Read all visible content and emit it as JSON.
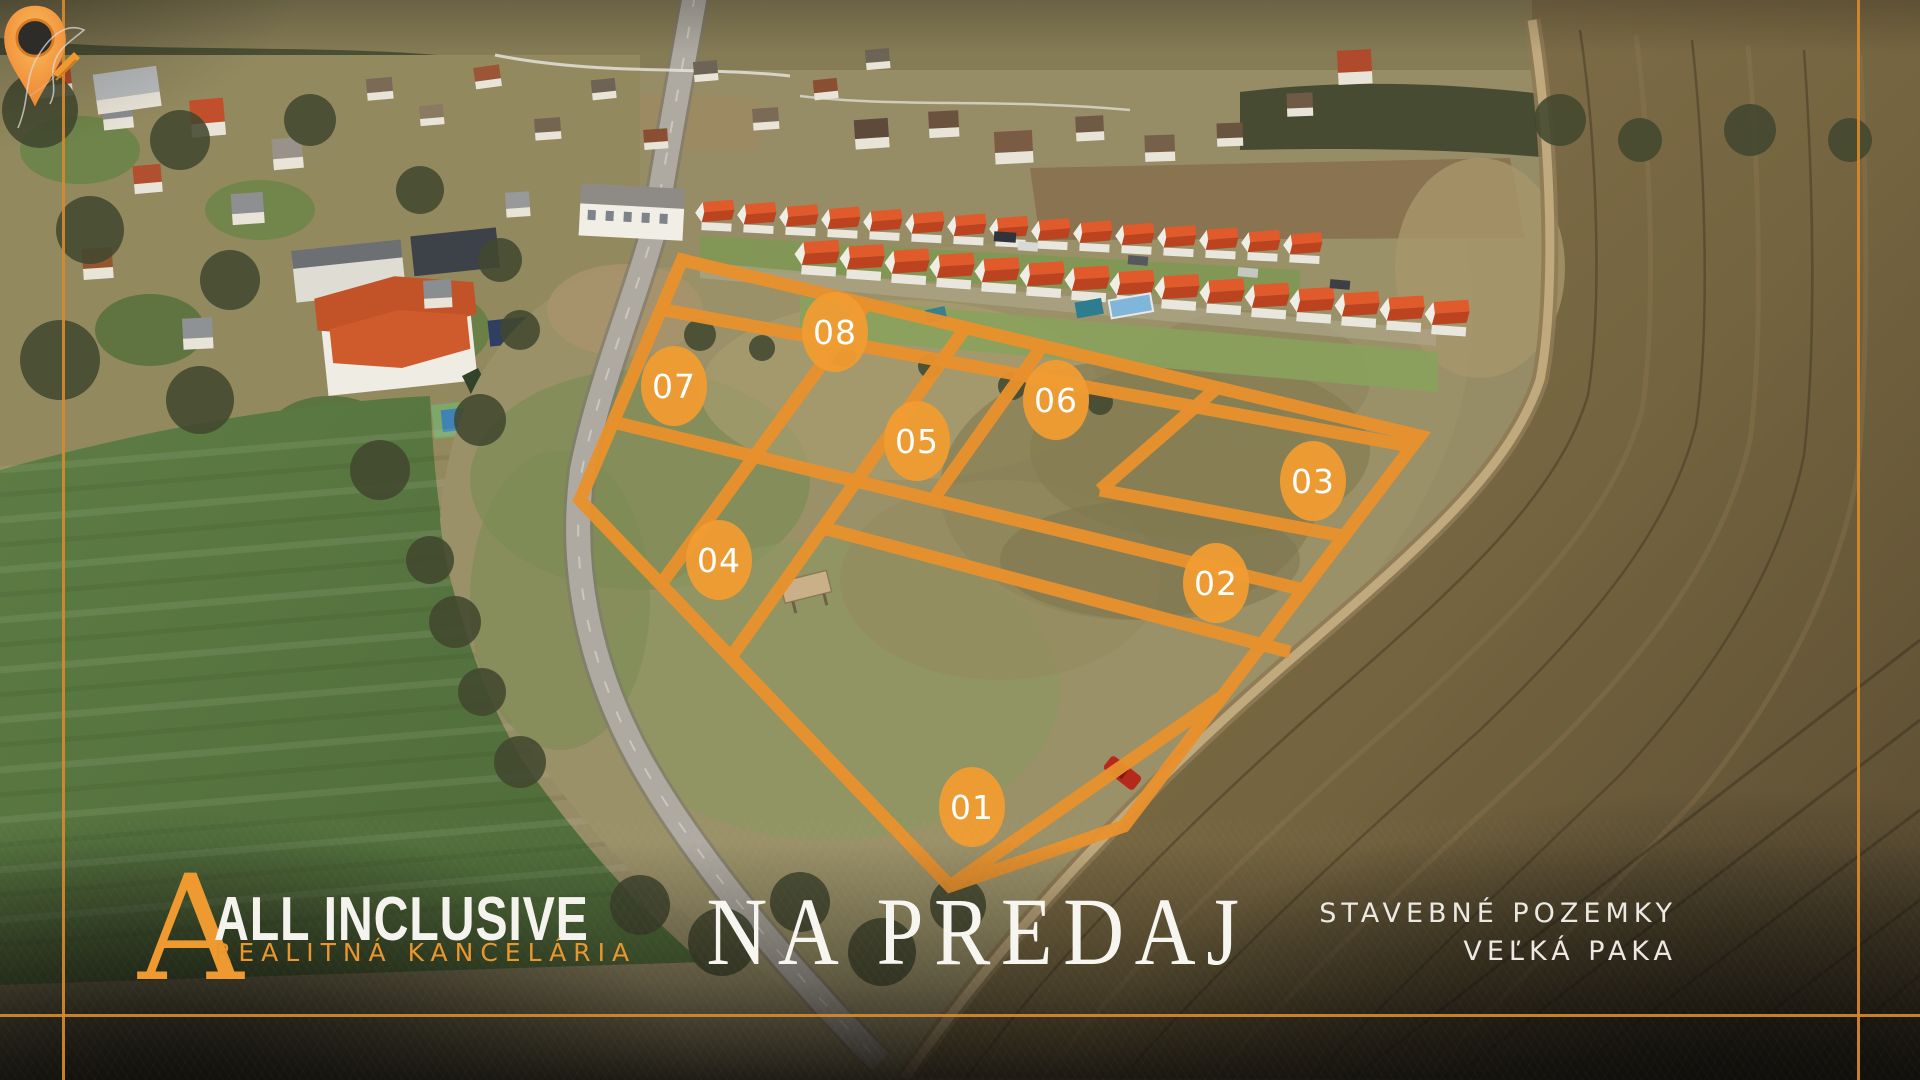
{
  "brand": {
    "monogram": "A",
    "line1": "ALL INCLUSIVE",
    "line2": "REALITNÁ KANCELÁRIA"
  },
  "headline": "NA PREDAJ",
  "location": {
    "line1": "STAVEBNÉ POZEMKY",
    "line2": "VEĽKÁ PAKA"
  },
  "site_plan": {
    "outline": "682,260 1420,436 1124,826 950,886 580,500",
    "lines": [
      [
        659,
        309,
        1410,
        446
      ],
      [
        613,
        422,
        1300,
        589
      ],
      [
        866,
        304,
        661,
        584
      ],
      [
        966,
        327,
        731,
        657
      ],
      [
        1043,
        345,
        932,
        501
      ],
      [
        1218,
        387,
        1100,
        490
      ],
      [
        1100,
        490,
        1348,
        537
      ],
      [
        823,
        528,
        1290,
        652
      ],
      [
        950,
        886,
        1220,
        698
      ]
    ],
    "labels": [
      {
        "id": "01",
        "x": 972,
        "y": 807
      },
      {
        "id": "02",
        "x": 1216,
        "y": 583
      },
      {
        "id": "03",
        "x": 1313,
        "y": 481
      },
      {
        "id": "04",
        "x": 719,
        "y": 560
      },
      {
        "id": "05",
        "x": 917,
        "y": 441
      },
      {
        "id": "06",
        "x": 1056,
        "y": 400
      },
      {
        "id": "07",
        "x": 674,
        "y": 386
      },
      {
        "id": "08",
        "x": 835,
        "y": 332
      }
    ],
    "stroke": "#E8912D",
    "label_fill": "#EF9C33",
    "label_text": "#FFFFFF"
  },
  "colors": {
    "accent_orange": "#E8912D",
    "frame_line": "#D8892B",
    "logo_orange": "#EE9A30"
  },
  "icons": {
    "pin": "location-pin-icon",
    "quill": "quill-icon"
  }
}
